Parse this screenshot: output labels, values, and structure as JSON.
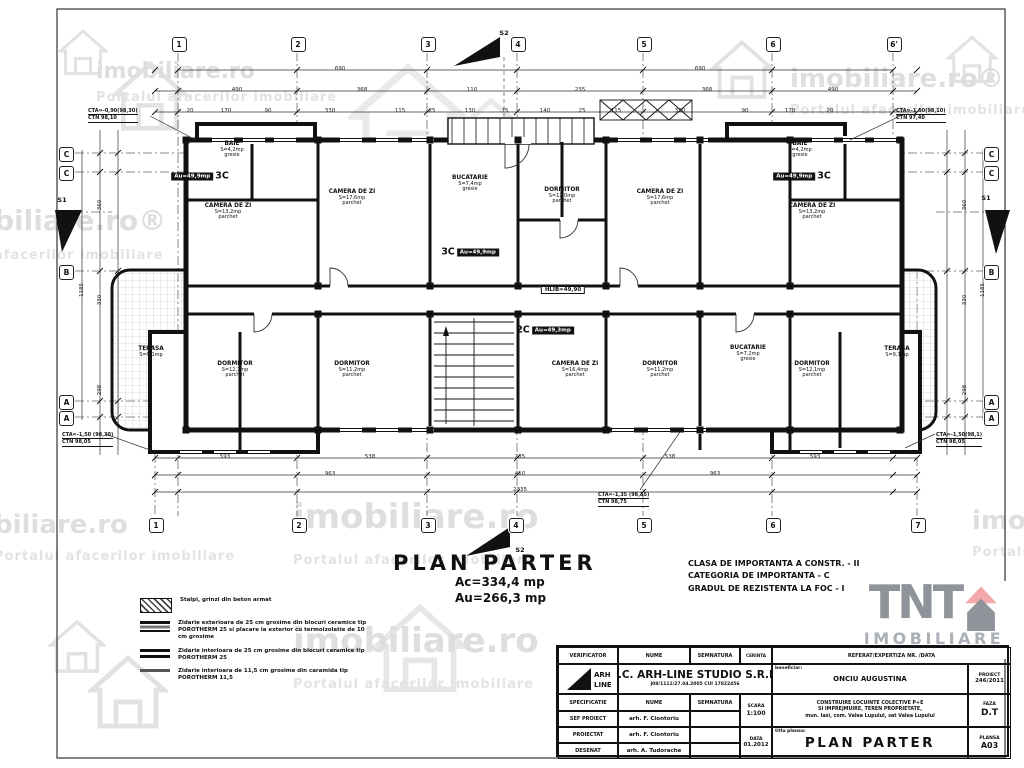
{
  "title": {
    "main": "PLAN PARTER",
    "ac": "Ac=334,4 mp",
    "au": "Au=266,3 mp"
  },
  "info": {
    "l1": "CLASA DE IMPORTANTA A CONSTR. - II",
    "l2": "CATEGORIA DE IMPORTANTA - C",
    "l3": "GRADUL DE REZISTENTA LA FOC - I"
  },
  "legend": {
    "items": [
      {
        "swatch": "sw-hatch",
        "text": "Stalpi, grinzi din beton armat"
      },
      {
        "swatch": "sw-wall3",
        "text": "Zidarie exterioara de 25 cm grosime din blocuri ceramice tip POROTHERM 25 si placare la exterior cu termoizolatie de 10 cm grosime"
      },
      {
        "swatch": "sw-wall2",
        "text": "Zidarie interioara de 25 cm grosime din blocuri ceramice tip POROTHERM 25"
      },
      {
        "swatch": "sw-wall1",
        "text": "Zidarie interioara de 11,5 cm grosime din caramida tip POROTHERM 11,5"
      }
    ]
  },
  "logo": {
    "tnt": "TNT",
    "imobiliare": "IMOBILIARE"
  },
  "watermarks": [
    {
      "x": 96,
      "y": 60,
      "size": 22,
      "main": "imobiliare.ro",
      "sub": "Portalul afacerilor imobiliare"
    },
    {
      "x": 185,
      "y": 146,
      "size": 40,
      "main": "imobiliare.ro",
      "sub": "Portalul afacerilor imobiliare"
    },
    {
      "x": -6,
      "y": 206,
      "size": 28,
      "main": "biliare.ro®",
      "sub": "afacerilor imobiliare"
    },
    {
      "x": 790,
      "y": 66,
      "size": 26,
      "main": "imobiliare.ro®",
      "sub": "Portalul afacerilor imobiliare"
    },
    {
      "x": -6,
      "y": 512,
      "size": 26,
      "main": "biliare.ro",
      "sub": "Portalul afacerilor imobiliare"
    },
    {
      "x": 293,
      "y": 500,
      "size": 34,
      "main": "imobiliare.ro",
      "sub": "Portalul afacerilor imobiliare"
    },
    {
      "x": 972,
      "y": 508,
      "size": 26,
      "main": "imobiliare.ro",
      "sub": "Portalul"
    },
    {
      "x": 293,
      "y": 624,
      "size": 34,
      "main": "imobiliare.ro",
      "sub": "Portalul afacerilor imobiliare"
    }
  ],
  "plan": {
    "grid": {
      "top": [
        {
          "x": 178,
          "n": "1"
        },
        {
          "x": 297,
          "n": "2"
        },
        {
          "x": 427,
          "n": "3"
        },
        {
          "x": 517,
          "n": "4"
        },
        {
          "x": 643,
          "n": "5"
        },
        {
          "x": 772,
          "n": "6"
        },
        {
          "x": 893,
          "n": "6'"
        }
      ],
      "bottom": [
        {
          "x": 155,
          "n": "1"
        },
        {
          "x": 298,
          "n": "2"
        },
        {
          "x": 427,
          "n": "3"
        },
        {
          "x": 515,
          "n": "4"
        },
        {
          "x": 643,
          "n": "5"
        },
        {
          "x": 772,
          "n": "6"
        },
        {
          "x": 917,
          "n": "7"
        }
      ],
      "left": [
        {
          "y": 153,
          "n": "C"
        },
        {
          "y": 172,
          "n": "C"
        },
        {
          "y": 271,
          "n": "B"
        },
        {
          "y": 401,
          "n": "A"
        },
        {
          "y": 417,
          "n": "A"
        }
      ],
      "right": [
        {
          "y": 153,
          "n": "C"
        },
        {
          "y": 172,
          "n": "C"
        },
        {
          "y": 271,
          "n": "B"
        },
        {
          "y": 401,
          "n": "A"
        },
        {
          "y": 417,
          "n": "A"
        }
      ]
    },
    "dims": [
      {
        "x": 340,
        "y": 69,
        "t": "690"
      },
      {
        "x": 700,
        "y": 69,
        "t": "690"
      },
      {
        "x": 237,
        "y": 90,
        "t": "490"
      },
      {
        "x": 362,
        "y": 90,
        "t": "368"
      },
      {
        "x": 472,
        "y": 90,
        "t": "110"
      },
      {
        "x": 580,
        "y": 90,
        "t": "235"
      },
      {
        "x": 707,
        "y": 90,
        "t": "368"
      },
      {
        "x": 833,
        "y": 90,
        "t": "490"
      },
      {
        "x": 190,
        "y": 111,
        "t": "20"
      },
      {
        "x": 226,
        "y": 111,
        "t": "170"
      },
      {
        "x": 268,
        "y": 111,
        "t": "90"
      },
      {
        "x": 330,
        "y": 111,
        "t": "330"
      },
      {
        "x": 400,
        "y": 111,
        "t": "115"
      },
      {
        "x": 432,
        "y": 111,
        "t": "25"
      },
      {
        "x": 470,
        "y": 111,
        "t": "130"
      },
      {
        "x": 505,
        "y": 111,
        "t": "75"
      },
      {
        "x": 545,
        "y": 111,
        "t": "140"
      },
      {
        "x": 582,
        "y": 111,
        "t": "25"
      },
      {
        "x": 616,
        "y": 111,
        "t": "115"
      },
      {
        "x": 680,
        "y": 111,
        "t": "330"
      },
      {
        "x": 745,
        "y": 111,
        "t": "90"
      },
      {
        "x": 790,
        "y": 111,
        "t": "170"
      },
      {
        "x": 830,
        "y": 111,
        "t": "20"
      },
      {
        "x": 225,
        "y": 457,
        "t": "593"
      },
      {
        "x": 370,
        "y": 457,
        "t": "538"
      },
      {
        "x": 520,
        "y": 457,
        "t": "235"
      },
      {
        "x": 670,
        "y": 457,
        "t": "538"
      },
      {
        "x": 815,
        "y": 457,
        "t": "593"
      },
      {
        "x": 330,
        "y": 474,
        "t": "963"
      },
      {
        "x": 520,
        "y": 474,
        "t": "410"
      },
      {
        "x": 715,
        "y": 474,
        "t": "963"
      },
      {
        "x": 520,
        "y": 490,
        "t": "2335"
      },
      {
        "x": 100,
        "y": 205,
        "t": "360",
        "r": 1
      },
      {
        "x": 100,
        "y": 300,
        "t": "330",
        "r": 1
      },
      {
        "x": 100,
        "y": 390,
        "t": "298",
        "r": 1
      },
      {
        "x": 82,
        "y": 290,
        "t": "1185",
        "r": 1
      },
      {
        "x": 965,
        "y": 205,
        "t": "360",
        "r": 1
      },
      {
        "x": 965,
        "y": 300,
        "t": "330",
        "r": 1
      },
      {
        "x": 965,
        "y": 390,
        "t": "298",
        "r": 1
      },
      {
        "x": 983,
        "y": 290,
        "t": "1185",
        "r": 1
      }
    ],
    "rooms": [
      {
        "x": 232,
        "y": 150,
        "n": "BAIE",
        "s": "S=4,2mp",
        "f": "gresie"
      },
      {
        "x": 228,
        "y": 212,
        "n": "CAMERA DE ZI",
        "s": "S=13,2mp",
        "f": "parchet"
      },
      {
        "x": 352,
        "y": 198,
        "n": "CAMERA DE ZI",
        "s": "S=17,6mp",
        "f": "parchet"
      },
      {
        "x": 470,
        "y": 184,
        "n": "BUCATARIE",
        "s": "S=7,4mp",
        "f": "gresie"
      },
      {
        "x": 562,
        "y": 196,
        "n": "DORMITOR",
        "s": "S=12,0mp",
        "f": "parchet"
      },
      {
        "x": 660,
        "y": 198,
        "n": "CAMERA DE ZI",
        "s": "S=17,6mp",
        "f": "parchet"
      },
      {
        "x": 800,
        "y": 150,
        "n": "BAIE",
        "s": "S=4,2mp",
        "f": "gresie"
      },
      {
        "x": 812,
        "y": 212,
        "n": "CAMERA DE ZI",
        "s": "S=13,2mp",
        "f": "parchet"
      },
      {
        "x": 151,
        "y": 352,
        "n": "TERASA",
        "s": "S=9,1mp",
        "f": ""
      },
      {
        "x": 235,
        "y": 370,
        "n": "DORMITOR",
        "s": "S=12,1mp",
        "f": "parchet"
      },
      {
        "x": 352,
        "y": 370,
        "n": "DORMITOR",
        "s": "S=11,2mp",
        "f": "parchet"
      },
      {
        "x": 575,
        "y": 370,
        "n": "CAMERA DE ZI",
        "s": "S=16,4mp",
        "f": "parchet"
      },
      {
        "x": 660,
        "y": 370,
        "n": "DORMITOR",
        "s": "S=11,2mp",
        "f": "parchet"
      },
      {
        "x": 748,
        "y": 354,
        "n": "BUCATARIE",
        "s": "S=7,2mp",
        "f": "gresie"
      },
      {
        "x": 812,
        "y": 370,
        "n": "DORMITOR",
        "s": "S=12,1mp",
        "f": "parchet"
      },
      {
        "x": 897,
        "y": 352,
        "n": "TERASA",
        "s": "S=9,1mp",
        "f": ""
      }
    ],
    "badges": [
      {
        "x": 200,
        "y": 176,
        "pill": "Au=49,9mp",
        "big": "3C",
        "order": "pf"
      },
      {
        "x": 802,
        "y": 176,
        "pill": "Au=49,9mp",
        "big": "3C",
        "order": "pf"
      },
      {
        "x": 470,
        "y": 252,
        "pill": "Au=49,9mp",
        "big": "3C",
        "order": "bf"
      },
      {
        "x": 545,
        "y": 330,
        "pill": "Au=49,3mp",
        "big": "2C",
        "order": "bf"
      }
    ],
    "hall_label": "HLIB=49,90",
    "annotations": [
      {
        "x": 88,
        "y": 108,
        "l1": "CTA=-0,90(98,30)",
        "l2": "CTN 98,10"
      },
      {
        "x": 896,
        "y": 108,
        "l1": "CTA=-1,50(98,10)",
        "l2": "CTN 97,40"
      },
      {
        "x": 62,
        "y": 432,
        "l1": "CTA=-1,50 (98,30)",
        "l2": "CTN 98,05"
      },
      {
        "x": 936,
        "y": 432,
        "l1": "CTA=-1,50(98,1)",
        "l2": "CTN 98,05"
      },
      {
        "x": 598,
        "y": 492,
        "l1": "CTA=-1,35 (98,35)",
        "l2": "CTN 98,75"
      }
    ],
    "sections": [
      {
        "x": 504,
        "y": 33,
        "t": "S2"
      },
      {
        "x": 520,
        "y": 550,
        "t": "S2"
      },
      {
        "x": 62,
        "y": 200,
        "t": "S1"
      },
      {
        "x": 986,
        "y": 198,
        "t": "S1"
      }
    ]
  },
  "titleblock": {
    "verificator": "VERIFICATOR",
    "nume": "NUME",
    "semnatura": "SEMNATURA",
    "cerinta": "CERINTA",
    "referat": "REFERAT/EXPERTIZA NR. /DATA",
    "company": "S.C. ARH-LINE STUDIO S.R.L.",
    "company_sub": "J08/1111/27.04.2005      CUI 17822456",
    "beneficiar_label": "beneficiar:",
    "beneficiar": "ONCIU AUGUSTINA",
    "proiect_label": "PROIECT",
    "proiect": "246/2011",
    "specificatie": "SPECIFICATIE",
    "nume2": "NUME",
    "semnatura2": "SEMNATURA",
    "scara_label": "SCARA",
    "scara": "1:100",
    "desc1": "CONSTRUIRE LOCUINTE COLECTIVE P+E",
    "desc2": "SI IMPREJMUIRE, TEREN PROPRIETATE,",
    "desc3": "mun. Iasi, com. Valea Lupului, sat Valea Lupului",
    "faza_label": "FAZA",
    "faza": "D.T",
    "sef_label": "SEF PROIECT",
    "sef": "arh. F. Ciontoriu",
    "proiectat_label": "PROIECTAT",
    "proiectat": "arh. F. Ciontoriu",
    "desenat_label": "DESENAT",
    "desenat": "arh. A. Tudorache",
    "data_label": "DATA",
    "data": "01.2012",
    "titlu_label": "titlu plansa:",
    "titlu": "PLAN PARTER",
    "plansa_label": "PLANSA",
    "plansa": "A03"
  }
}
